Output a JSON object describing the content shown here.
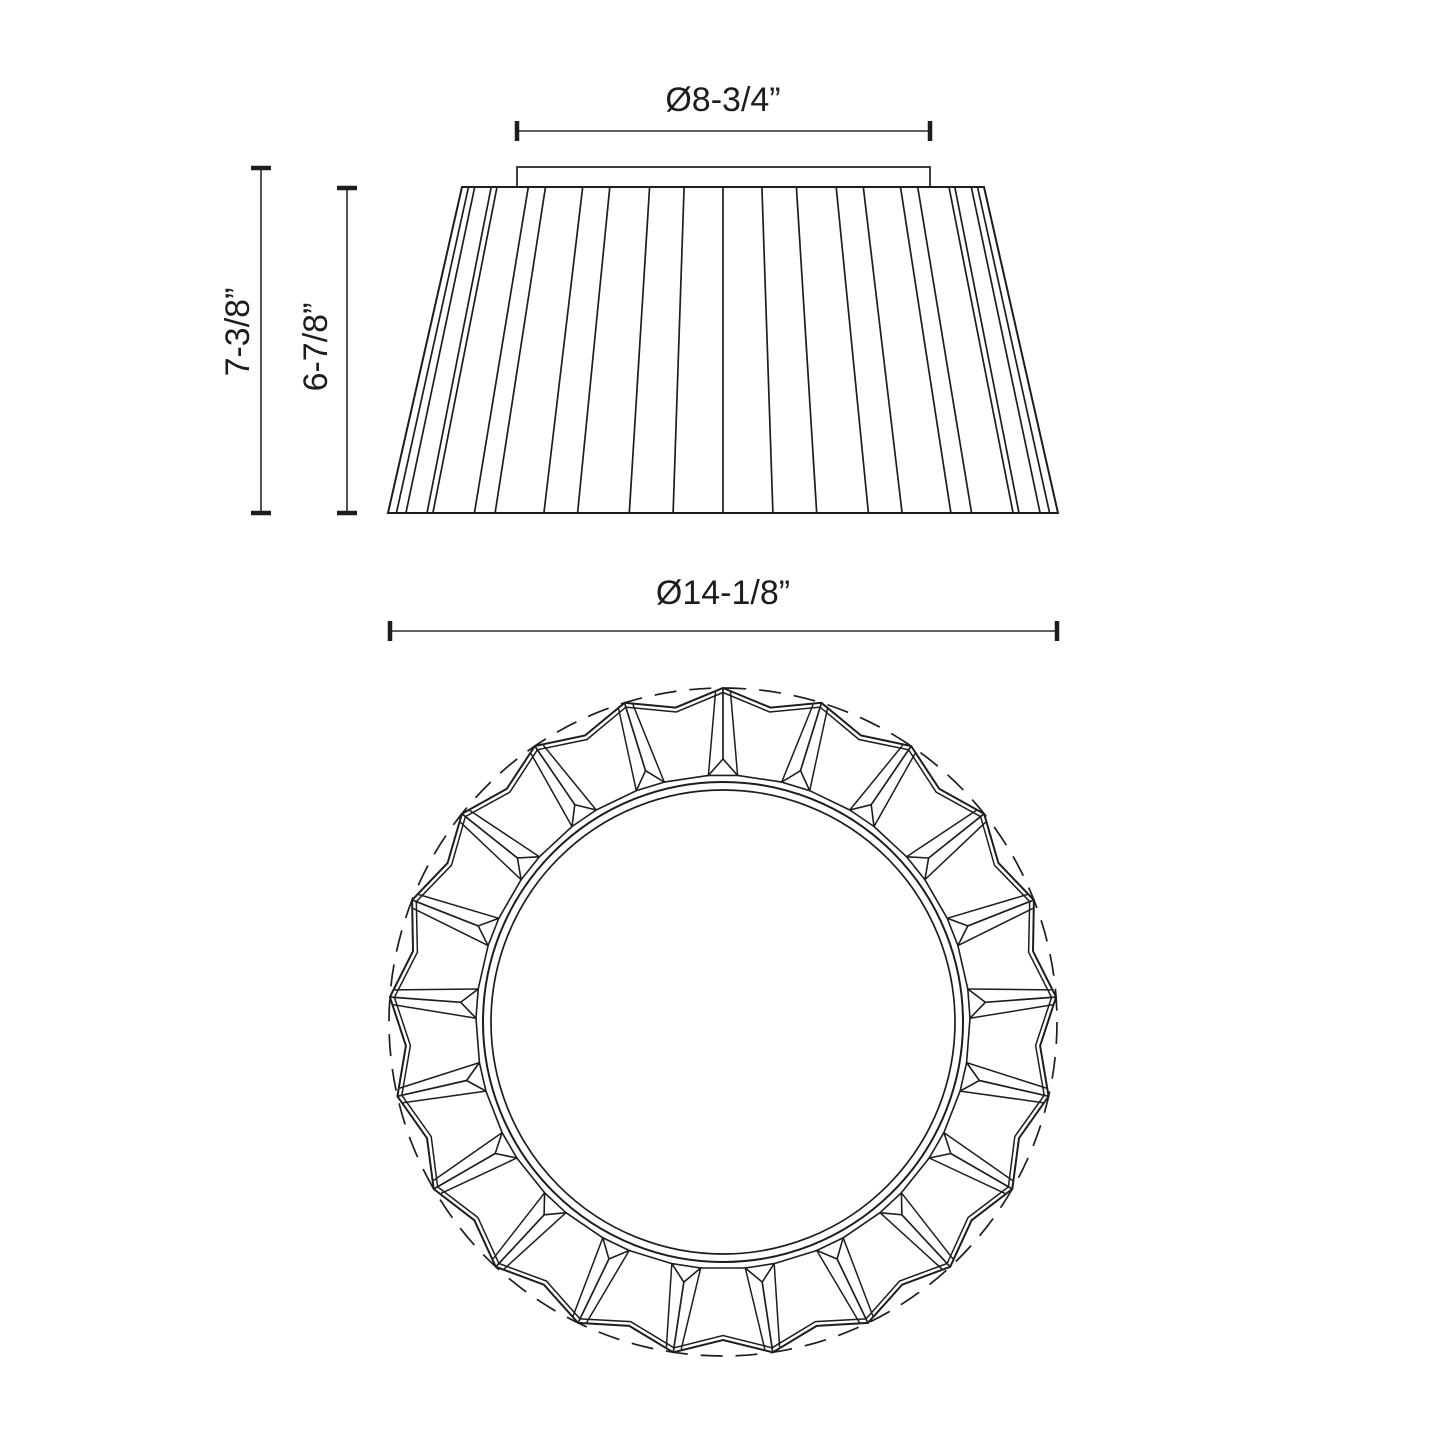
{
  "drawing": {
    "dimensions": {
      "canopy_diameter": "Ø8-3/4”",
      "overall_height": "7-3/8”",
      "shade_height": "6-7/8”",
      "bottom_diameter": "Ø14-1/8”"
    },
    "pleat_count": 21,
    "colors": {
      "line": "#1d1d1b",
      "dimension": "#2a2a2a",
      "background": "#ffffff"
    }
  }
}
